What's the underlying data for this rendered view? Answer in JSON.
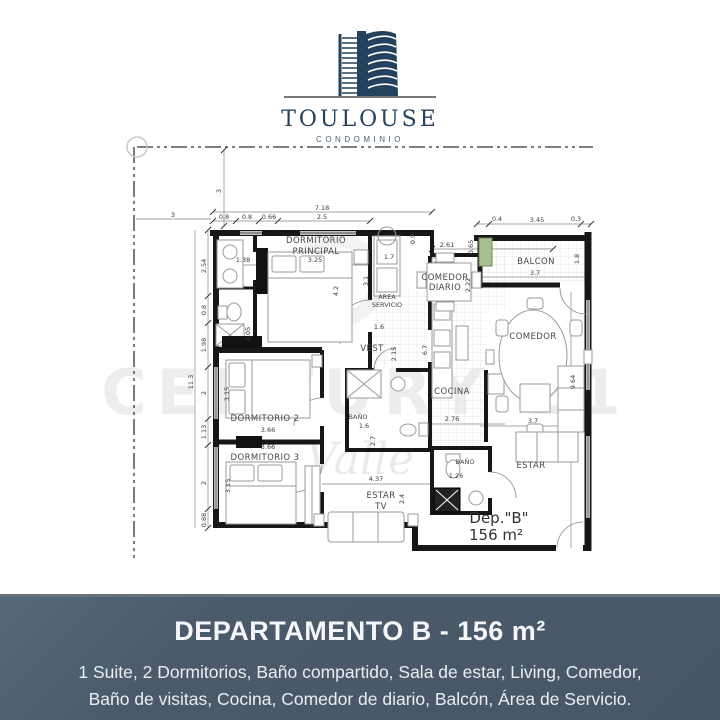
{
  "logo": {
    "title": "TOULOUSE",
    "subtitle": "CONDOMINIO"
  },
  "watermark": {
    "brand": "CENTURY 21",
    "script": "Valle"
  },
  "plan": {
    "unit": {
      "name": "Dep.\"B\"",
      "area": "156 m²"
    },
    "rooms": {
      "dorm_principal_l1": "DORMITORIO",
      "dorm_principal_l2": "PRINCIPAL",
      "area_servicio_l1": "AREA",
      "area_servicio_l2": "SERVICIO",
      "comedor_diario_l1": "COMEDOR",
      "comedor_diario_l2": "DIARIO",
      "balcon": "BALCON",
      "comedor": "COMEDOR",
      "vest": "VEST",
      "cocina": "COCINA",
      "dorm2": "DORMITORIO 2",
      "dorm3": "DORMITORIO 3",
      "bano": "BAÑO",
      "bano_visitas": "BAÑO",
      "estar": "ESTAR",
      "estar_tv_l1": "ESTAR",
      "estar_tv_l2": "TV"
    },
    "dims": {
      "bnd_v3": "3",
      "bnd_h3": "3",
      "t718": "7.18",
      "t08a": "0.8",
      "t08b": "0.8",
      "t066": "0.66",
      "t25": "2.5",
      "t261": "2.61",
      "t09": "0.9",
      "t065": "0.65",
      "t04": "0.4",
      "t345": "3.45",
      "t03": "0.3",
      "t18": "1.8",
      "balc37": "3.7",
      "l254": "2.54",
      "l08": "0.8",
      "l198": "1.98",
      "l2a": "2",
      "l113": "1.13",
      "l2b": "2",
      "l088": "0.88",
      "l113t": "11.3",
      "dp138": "1.38",
      "dp325": "3.25",
      "dp42": "4.2",
      "dp205": "2.05",
      "as17": "1.7",
      "as31": "3.1",
      "cd222": "2.22",
      "v16": "1.6",
      "v215": "2.15",
      "v67": "6.7",
      "c276": "2.76",
      "c964": "9.64",
      "d2_315": "3.15",
      "d2_366": "3.66",
      "d3_366": "3.66",
      "d3_315": "3.15",
      "b16": "1.6",
      "b27": "2.7",
      "bv126": "1.26",
      "e437": "4.37",
      "e24": "2.4",
      "est37": "3.7"
    }
  },
  "banner": {
    "title": "DEPARTAMENTO B - 156 m²",
    "line1": "1 Suite, 2 Dormitorios, Baño compartido, Sala de estar, Living, Comedor,",
    "line2": "Baño de visitas, Cocina, Comedor de diario, Balcón, Área de Servicio."
  }
}
